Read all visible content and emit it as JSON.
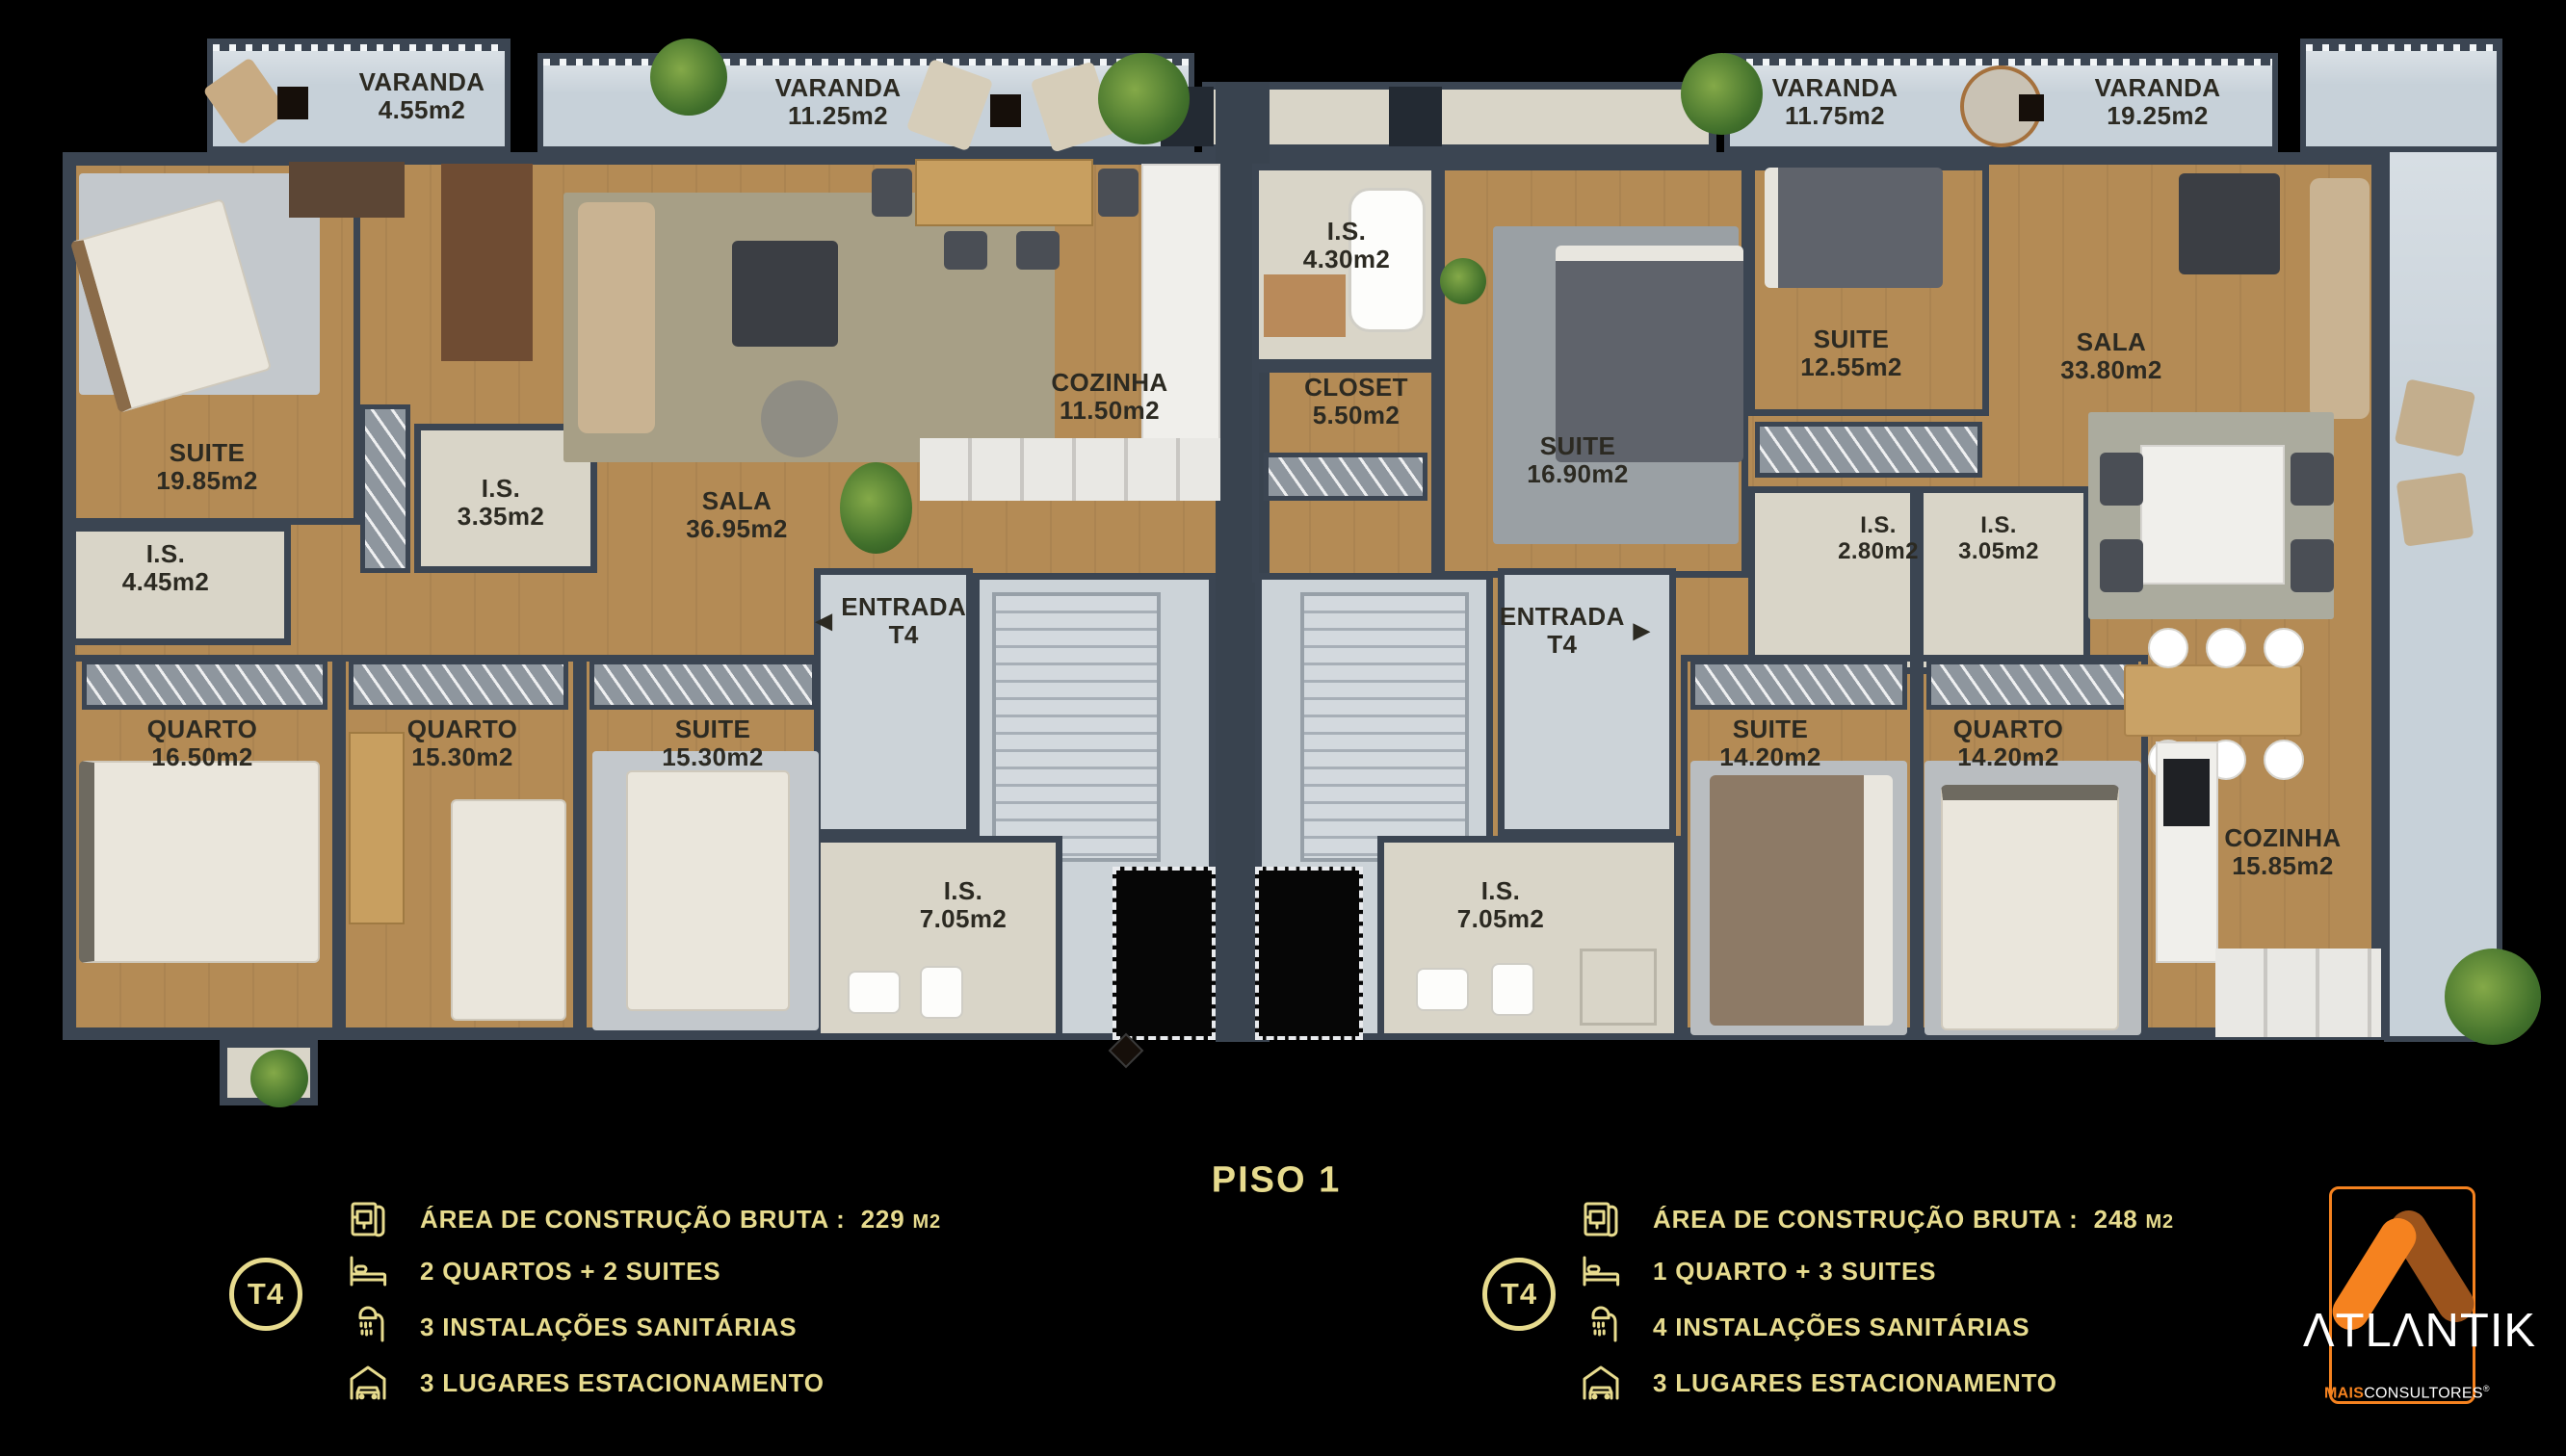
{
  "page": {
    "title": "PISO 1"
  },
  "colors": {
    "gold": "#e7db8e",
    "orange": "#f5821f",
    "dark_orange": "#9b531c",
    "wall": "#3b4552",
    "wood": "#b48b55"
  },
  "units": [
    {
      "badge": "T4",
      "varandas": [
        {
          "name": "VARANDA",
          "area": "4.55m2"
        },
        {
          "name": "VARANDA",
          "area": "11.25m2"
        }
      ],
      "entrada": {
        "label": "ENTRADA",
        "sub": "T4",
        "arrow": "◀"
      },
      "rooms": [
        {
          "name": "SUITE",
          "area": "19.85m2"
        },
        {
          "name": "I.S.",
          "area": "4.45m2"
        },
        {
          "name": "I.S.",
          "area": "3.35m2"
        },
        {
          "name": "SALA",
          "area": "36.95m2"
        },
        {
          "name": "COZINHA",
          "area": "11.50m2"
        },
        {
          "name": "QUARTO",
          "area": "16.50m2"
        },
        {
          "name": "QUARTO",
          "area": "15.30m2"
        },
        {
          "name": "SUITE",
          "area": "15.30m2"
        },
        {
          "name": "I.S.",
          "area": "7.05m2"
        }
      ],
      "legend": {
        "area": {
          "icon": "blueprint-icon",
          "label": "ÁREA DE CONSTRUÇÃO BRUTA :",
          "value": "229",
          "unit": "M2"
        },
        "rows": [
          {
            "icon": "bed-icon",
            "text": "2 QUARTOS + 2 SUITES"
          },
          {
            "icon": "shower-icon",
            "text": "3 INSTALAÇÕES SANITÁRIAS"
          },
          {
            "icon": "garage-icon",
            "text": "3 LUGARES ESTACIONAMENTO"
          }
        ]
      }
    },
    {
      "badge": "T4",
      "varandas": [
        {
          "name": "VARANDA",
          "area": "11.75m2"
        },
        {
          "name": "VARANDA",
          "area": "19.25m2"
        }
      ],
      "entrada": {
        "label": "ENTRADA",
        "sub": "T4",
        "arrow": "▶"
      },
      "rooms": [
        {
          "name": "I.S.",
          "area": "4.30m2"
        },
        {
          "name": "CLOSET",
          "area": "5.50m2"
        },
        {
          "name": "SUITE",
          "area": "16.90m2"
        },
        {
          "name": "SUITE",
          "area": "12.55m2"
        },
        {
          "name": "I.S.",
          "area": "2.80m2"
        },
        {
          "name": "I.S.",
          "area": "3.05m2"
        },
        {
          "name": "SALA",
          "area": "33.80m2"
        },
        {
          "name": "SUITE",
          "area": "14.20m2"
        },
        {
          "name": "QUARTO",
          "area": "14.20m2"
        },
        {
          "name": "COZINHA",
          "area": "15.85m2"
        },
        {
          "name": "I.S.",
          "area": "7.05m2"
        }
      ],
      "legend": {
        "area": {
          "icon": "blueprint-icon",
          "label": "ÁREA DE CONSTRUÇÃO BRUTA :",
          "value": "248",
          "unit": "M2"
        },
        "rows": [
          {
            "icon": "bed-icon",
            "text": "1 QUARTO + 3 SUITES"
          },
          {
            "icon": "shower-icon",
            "text": "4 INSTALAÇÕES SANITÁRIAS"
          },
          {
            "icon": "garage-icon",
            "text": "3 LUGARES ESTACIONAMENTO"
          }
        ]
      }
    }
  ],
  "brand": {
    "display": "ΛTLΛNTIK",
    "sub_bold": "MAIS",
    "sub_rest": "CONSULTORES",
    "registered": "®"
  }
}
